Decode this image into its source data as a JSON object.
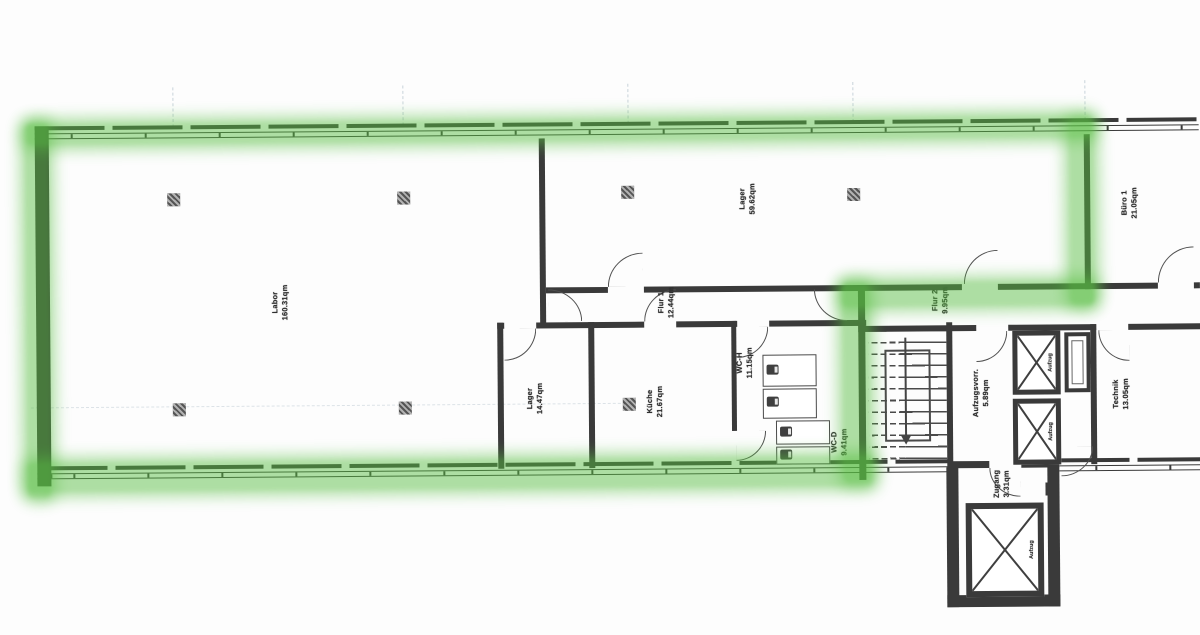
{
  "colors": {
    "wall": "#3a3a3a",
    "wallLight": "#505050",
    "highlight": "#58be42",
    "grid": "#bcc9d2",
    "text": "#2f2f2f"
  },
  "rooms": {
    "labor": {
      "label": "Labor",
      "area": "160.31qm"
    },
    "lager_gross": {
      "label": "Lager",
      "area": "59.62qm"
    },
    "buero1": {
      "label": "Büro 1",
      "area": "21.05qm"
    },
    "flur1": {
      "label": "Flur 1",
      "area": "12.44qm"
    },
    "flur2": {
      "label": "Flur 2",
      "area": "9.95qm"
    },
    "lager_klein": {
      "label": "Lager",
      "area": "14.47qm"
    },
    "kueche": {
      "label": "Küche",
      "area": "21.67qm"
    },
    "wc_h": {
      "label": "WC-H",
      "area": "11.15qm"
    },
    "wc_d": {
      "label": "WC-D",
      "area": "9.41qm"
    },
    "aufzugsvorraum": {
      "label": "Aufzugsvorr.",
      "area": "5.89qm"
    },
    "technik": {
      "label": "Technik",
      "area": "13.05qm"
    },
    "zugang": {
      "label": "Zugang",
      "area": "3.31qm"
    }
  },
  "elevators": {
    "label": "Aufzug"
  }
}
